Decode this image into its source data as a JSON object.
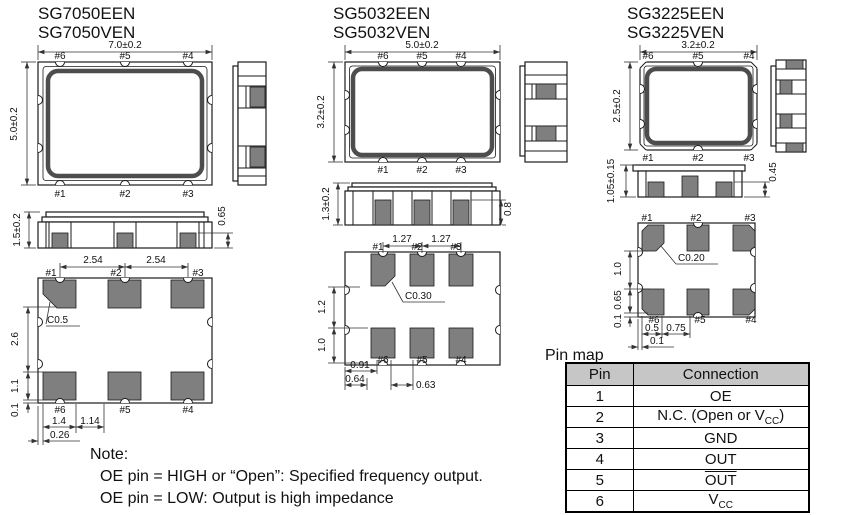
{
  "packages": [
    {
      "title_line1": "SG7050EEN",
      "title_line2": "SG7050VEN",
      "top_view": {
        "width_dim": "7.0±0.2",
        "height_dim": "5.0±0.2",
        "pins_top": [
          "#6",
          "#5",
          "#4"
        ],
        "pins_bottom": [
          "#1",
          "#2",
          "#3"
        ]
      },
      "front_view": {
        "height_dim": "1.5±0.2",
        "pad_dim": "0.65"
      },
      "bottom_view": {
        "pitch_dims": [
          "2.54",
          "2.54"
        ],
        "pins_top": [
          "#1",
          "#2",
          "#3"
        ],
        "pins_bottom": [
          "#6",
          "#5",
          "#4"
        ],
        "chamfer": "C0.5",
        "side_dims": [
          "2.6",
          "1.1",
          "0.1"
        ],
        "bottom_dims": [
          "1.4",
          "1.14",
          "0.26"
        ]
      }
    },
    {
      "title_line1": "SG5032EEN",
      "title_line2": "SG5032VEN",
      "top_view": {
        "width_dim": "5.0±0.2",
        "height_dim": "3.2±0.2",
        "pins_top": [
          "#6",
          "#5",
          "#4"
        ],
        "pins_bottom": [
          "#1",
          "#2",
          "#3"
        ]
      },
      "front_view": {
        "height_dim": "1.3±0.2",
        "pad_dim": "0.8"
      },
      "bottom_view": {
        "pitch_dims": [
          "1.27",
          "1.27"
        ],
        "pins_top": [
          "#1",
          "#2",
          "#3"
        ],
        "pins_bottom": [
          "#6",
          "#5",
          "#4"
        ],
        "chamfer": "C0.30",
        "side_dims": [
          "1.2",
          "1.0"
        ],
        "bottom_dims": [
          "0.91",
          "0.64",
          "0.63"
        ]
      }
    },
    {
      "title_line1": "SG3225EEN",
      "title_line2": "SG3225VEN",
      "top_view": {
        "width_dim": "3.2±0.2",
        "height_dim": "2.5±0.2",
        "pins_top": [
          "#6",
          "#5",
          "#4"
        ],
        "pins_bottom": [
          "#1",
          "#2",
          "#3"
        ]
      },
      "front_view": {
        "height_dim": "1.05±0.15",
        "pad_dim": "0.45"
      },
      "bottom_view": {
        "pins_top": [
          "#1",
          "#2",
          "#3"
        ],
        "pins_bottom": [
          "#6",
          "#5",
          "#4"
        ],
        "chamfer": "C0.20",
        "side_dims": [
          "1.0",
          "0.65",
          "0.1"
        ],
        "bottom_dims": [
          "0.5",
          "0.75",
          "0.1"
        ]
      }
    }
  ],
  "pin_map": {
    "title": "Pin map",
    "col_pin": "Pin",
    "col_connection": "Connection",
    "rows": [
      {
        "pin": "1",
        "conn": "OE"
      },
      {
        "pin": "2",
        "conn_pre": "N.C. (Open or V",
        "conn_sub": "CC",
        "conn_post": ")"
      },
      {
        "pin": "3",
        "conn": "GND"
      },
      {
        "pin": "4",
        "conn": "OUT"
      },
      {
        "pin": "5",
        "conn": "OUT",
        "overline": true
      },
      {
        "pin": "6",
        "conn_pre": "V",
        "conn_sub": "CC"
      }
    ]
  },
  "note": {
    "label": "Note:",
    "line1": "OE pin = HIGH or “Open”: Specified frequency output.",
    "line2": "OE pin = LOW: Output is high impedance"
  },
  "colors": {
    "pad_gray": "#7f7f7f",
    "ring_gray": "#4d4d4d",
    "line": "#1a1a1a",
    "table_header_bg": "#c6c6c6"
  }
}
